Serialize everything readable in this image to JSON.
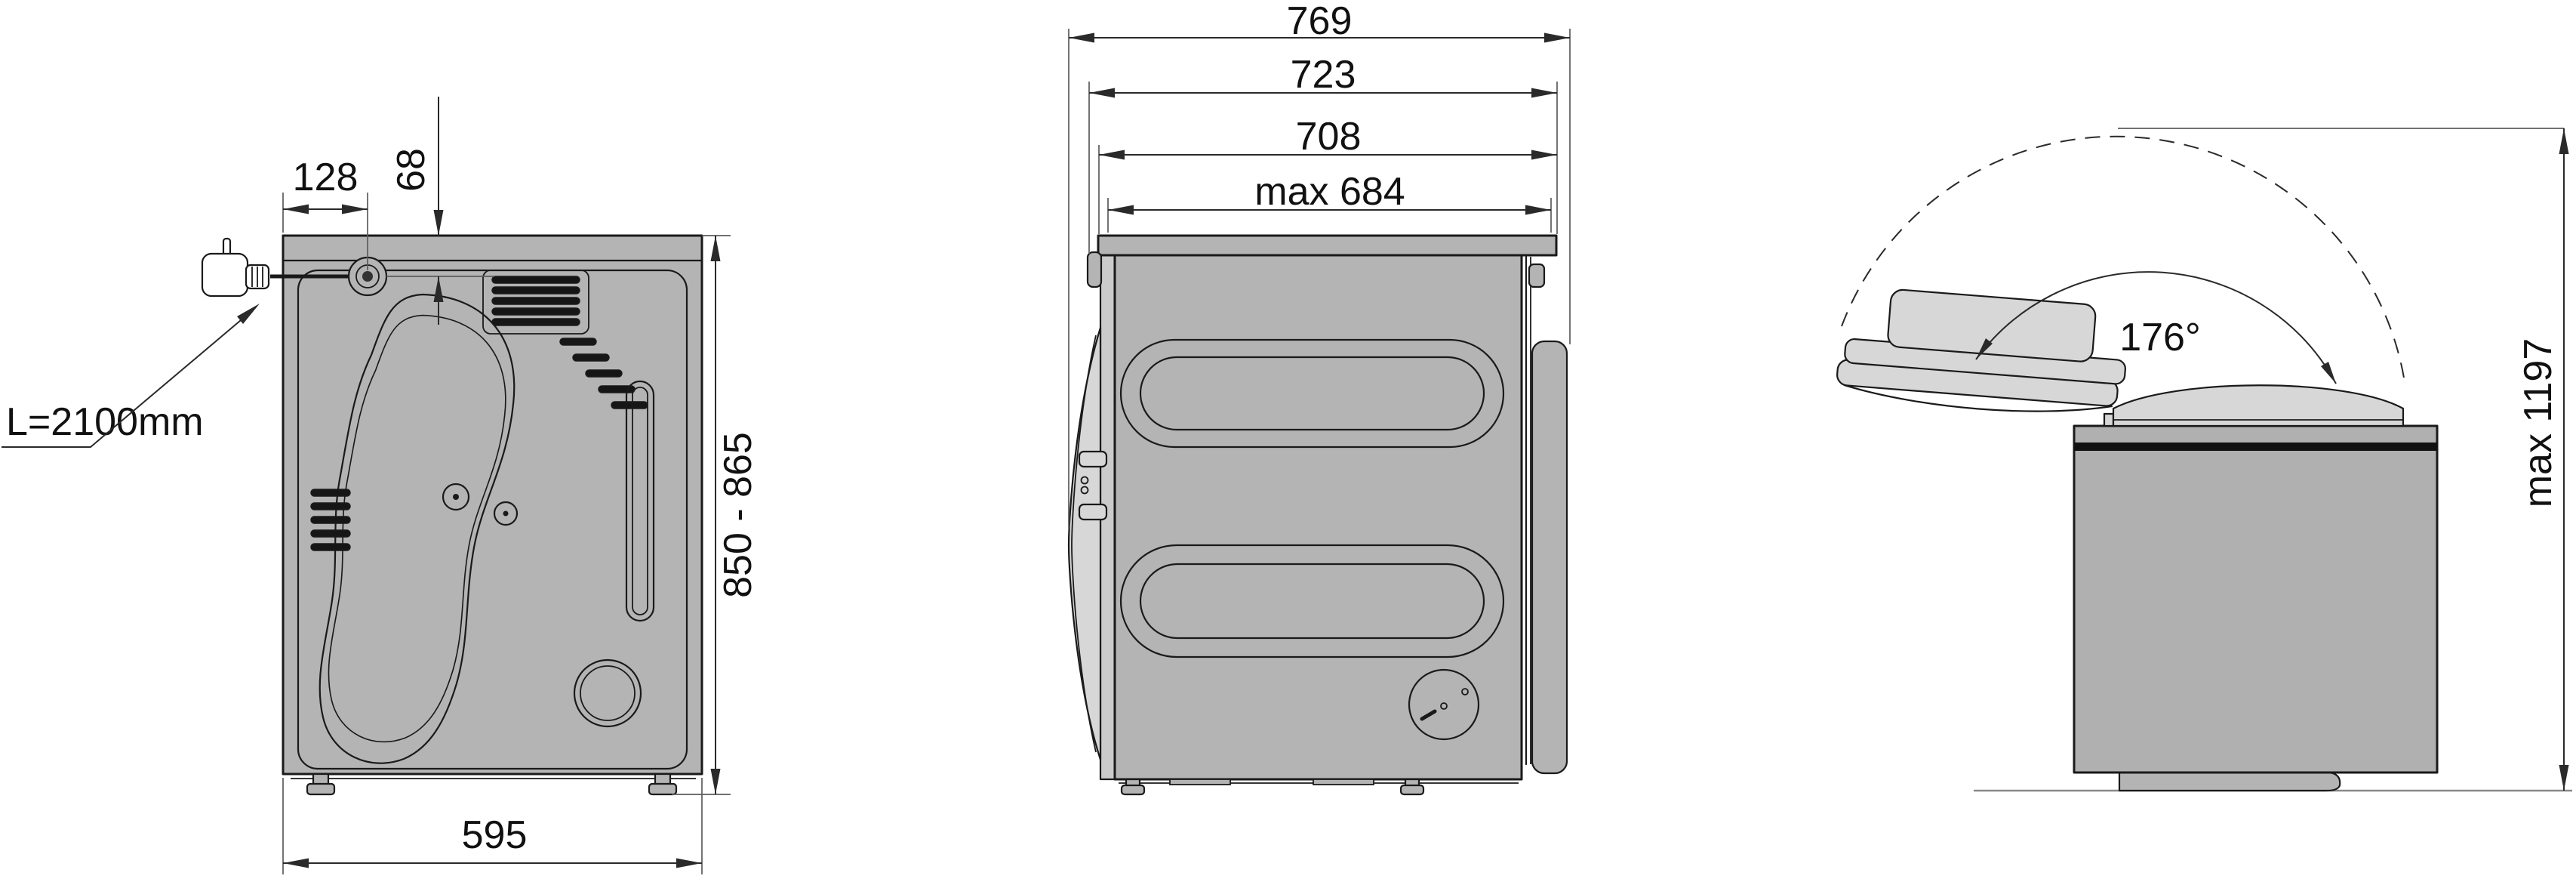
{
  "title": "Appliance installation dimensions diagram",
  "dims": {
    "rear": {
      "cable_length": "L=2100mm",
      "cable_offset_horizontal": "128",
      "cable_offset_vertical": "68",
      "height_range": "850 - 865",
      "width": "595"
    },
    "side": {
      "depth_overall": "769",
      "depth_worktop": "723",
      "depth_housing": "708",
      "depth_opening": "max 684"
    },
    "lid": {
      "opening_angle": "176°",
      "open_height": "max 1197"
    }
  },
  "colors": {
    "body": "#b4b4b4",
    "body2": "#b0b0b0",
    "panel": "#d7d7d7",
    "strip": "#cbcbcb",
    "outline": "#1a1a1a",
    "dim": "#2a2a2a",
    "ext": "#5c5c5c",
    "floor": "#8a8a8a",
    "text": "#111111",
    "slat": "#161616"
  }
}
